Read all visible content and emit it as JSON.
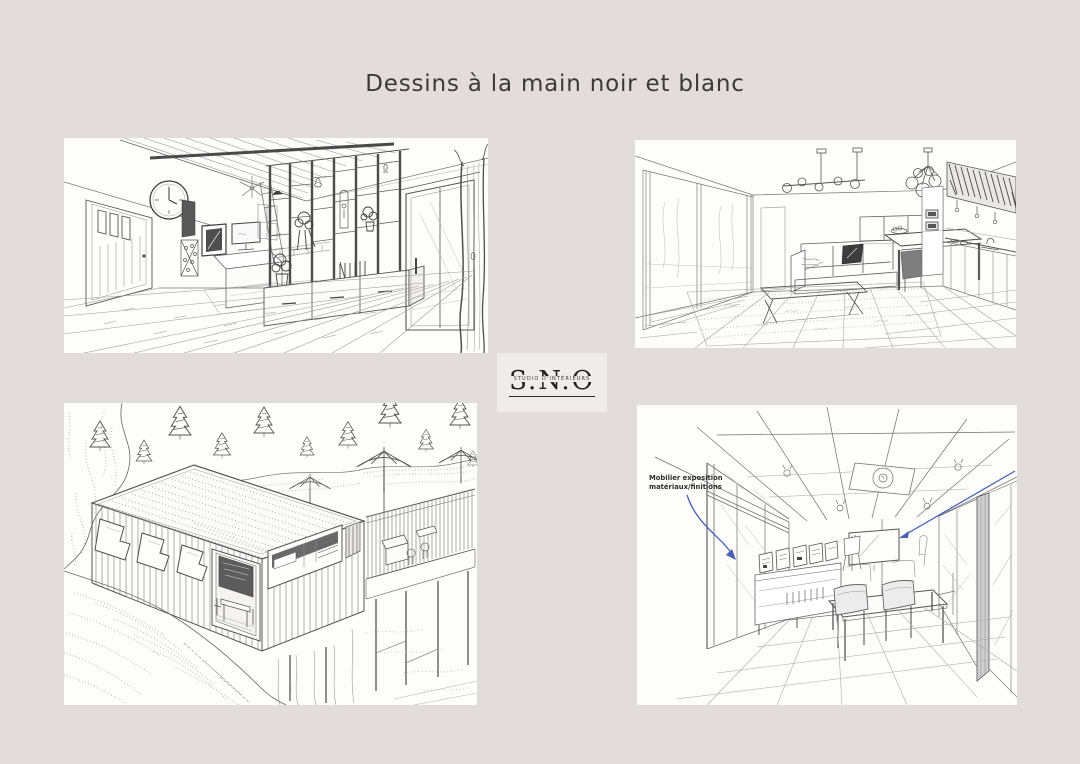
{
  "page": {
    "title": "Dessins à la main noir et blanc",
    "background_color": "#e2dcda"
  },
  "logo": {
    "name": "S.N.O",
    "subtitle": "STUDIO D'INTÉRIEURS",
    "box_color": "#f0ecea"
  },
  "panels": {
    "top_left": {
      "description": "Croquis crayon : séjour avec claustra bois, horloge et baie vitrée"
    },
    "top_right": {
      "description": "Croquis crayon : salon ouvert sur cuisine, canapé et îlot"
    },
    "bottom_left": {
      "description": "Croquis crayon : guinguette à toit plat avec terrasse et parasols"
    },
    "bottom_right": {
      "description": "Croquis crayon : salle d'exposition matériaux avec table de réunion",
      "note_line1": "Mobilier exposition",
      "note_line2": "matériaux/finitions",
      "note_color": "#4660b4"
    }
  }
}
